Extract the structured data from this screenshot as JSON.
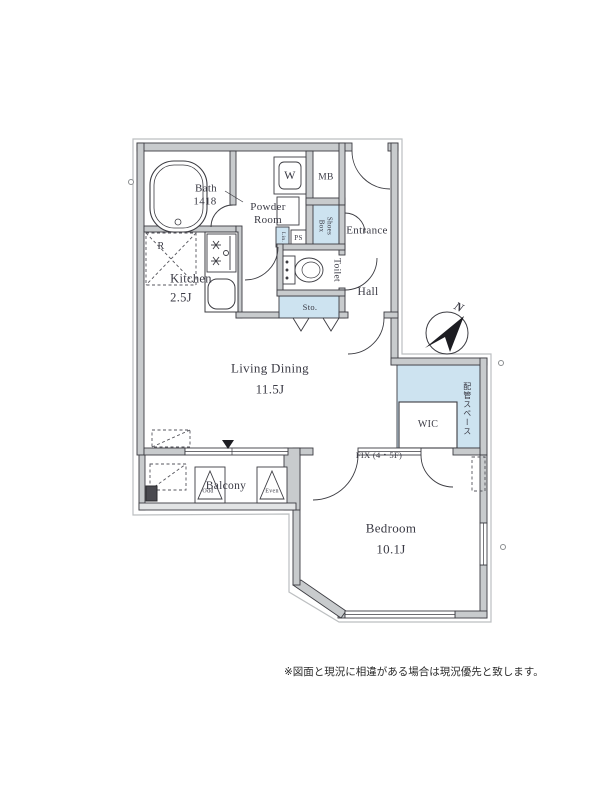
{
  "plan": {
    "rooms": {
      "bath": {
        "label": "Bath",
        "size": "1418"
      },
      "powder_room": {
        "label": "Powder\nRoom"
      },
      "kitchen": {
        "label": "Kitchen",
        "size": "2.5J"
      },
      "living_dining": {
        "label": "Living Dining",
        "size": "11.5J"
      },
      "bedroom": {
        "label": "Bedroom",
        "size": "10.1J"
      },
      "entrance": {
        "label": "Entrance"
      },
      "hall": {
        "label": "Hall"
      },
      "toilet": {
        "label": "Toilet"
      },
      "wic": {
        "label": "WIC"
      },
      "balcony": {
        "label": "Balcony"
      }
    },
    "labels": {
      "washer": "W",
      "meter_box": "MB",
      "shoes_box": "Shoes\nBox",
      "linen": "Lin.",
      "pipe_shaft": "PS",
      "storage": "Sto.",
      "refrigerator": "R",
      "fix_window": "FIX (4・5F)",
      "pipe_space": "配管スペース",
      "hatch_odd": "Odd",
      "hatch_even": "Even"
    },
    "compass": {
      "north": "N"
    },
    "note": "※図面と現況に相違がある場合は現況優先と致します。",
    "colors": {
      "wall_fill": "#c8cbcd",
      "line": "#3c3c42",
      "highlight_fill": "#cde3f0"
    }
  }
}
